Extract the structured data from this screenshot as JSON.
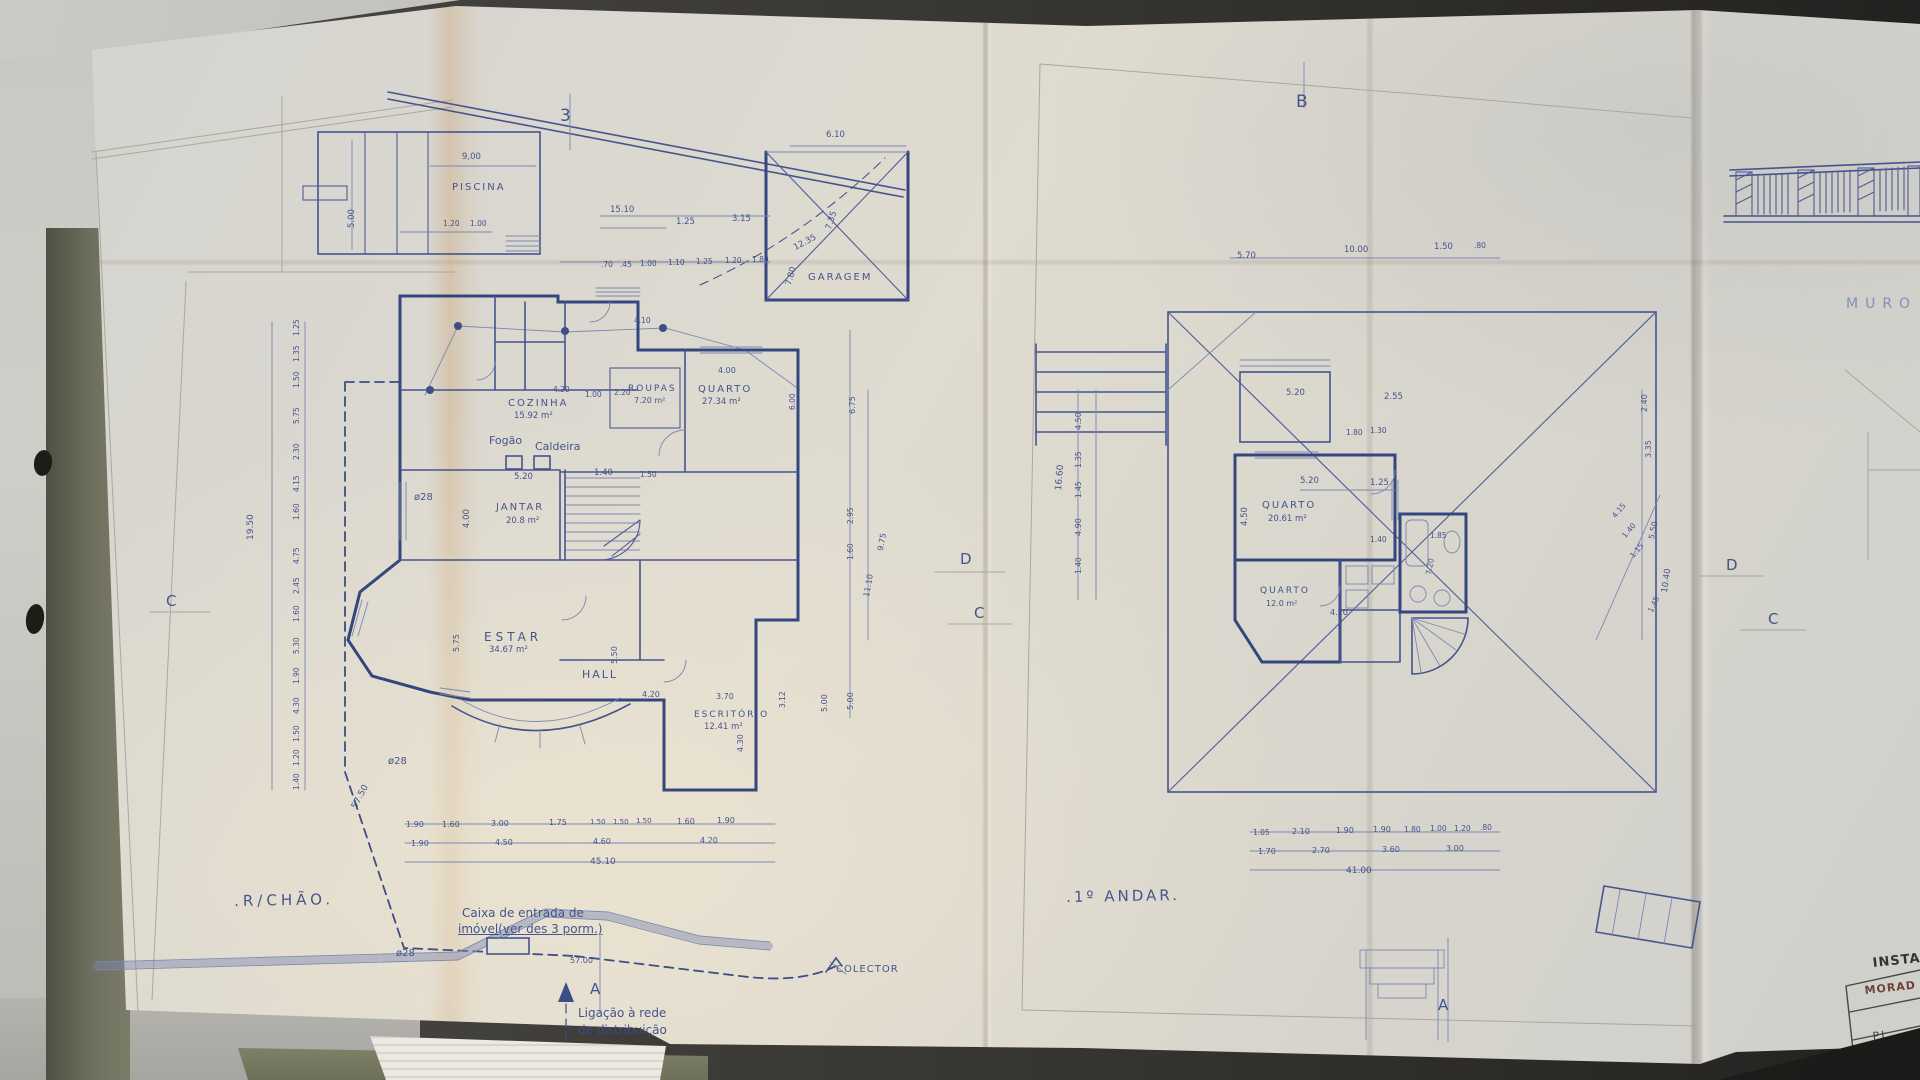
{
  "photo": {
    "paper_color": "#dcd8cd",
    "ink_color": "#44549a",
    "wall_ink_color": "#35467e",
    "pencil_color": "#a9a89e",
    "desk_color": "#c6c5c1",
    "folder_color": "#6e6f5d",
    "stamp_color": "#66392e"
  },
  "left_plan": {
    "title": ".R/CHÃO.",
    "caixa_line1": "Caixa de entrada de",
    "caixa_line2": "imóvel(ver des 3 porm.)",
    "ligacao_line1": "Ligação à rede",
    "ligacao_line2": "de distribuição"
  },
  "right_plan": {
    "title": ".1º ANDAR."
  },
  "right_strip": {
    "muro": "MURO",
    "titleblock_line1": "INSTAL",
    "titleblock_line2": "MORAD",
    "titleblock_line3": "PL"
  },
  "markers": [
    {
      "t": "3",
      "x": 560,
      "y": 106,
      "fs": 17
    },
    {
      "t": "B",
      "x": 1296,
      "y": 92,
      "fs": 17
    },
    {
      "t": "C",
      "x": 166,
      "y": 592
    },
    {
      "t": "D",
      "x": 960,
      "y": 550
    },
    {
      "t": "C",
      "x": 974,
      "y": 604
    },
    {
      "t": "D",
      "x": 1726,
      "y": 556
    },
    {
      "t": "C",
      "x": 1768,
      "y": 610
    },
    {
      "t": "A",
      "x": 590,
      "y": 980
    },
    {
      "t": "A",
      "x": 1438,
      "y": 996
    }
  ],
  "room_labels": [
    {
      "t": "PISCINA",
      "x": 452,
      "y": 182
    },
    {
      "t": "GARAGEM",
      "x": 808,
      "y": 272
    },
    {
      "t": "COZINHA",
      "x": 508,
      "y": 398
    },
    {
      "t": "ROUPAS",
      "x": 628,
      "y": 384,
      "fs": 9
    },
    {
      "t": "QUARTO",
      "x": 698,
      "y": 384
    },
    {
      "t": "JANTAR",
      "x": 496,
      "y": 502
    },
    {
      "t": "ESTAR",
      "x": 484,
      "y": 630,
      "fs": 12,
      "ls": 4
    },
    {
      "t": "HALL",
      "x": 582,
      "y": 668,
      "fs": 11
    },
    {
      "t": "ESCRITÓRIO",
      "x": 694,
      "y": 710,
      "fs": 9
    },
    {
      "t": "QUARTO",
      "x": 1262,
      "y": 500
    },
    {
      "t": "QUARTO",
      "x": 1260,
      "y": 586,
      "fs": 9
    }
  ],
  "area_labels": [
    {
      "t": "15.92 m²",
      "x": 514,
      "y": 411
    },
    {
      "t": "7.20 m²",
      "x": 634,
      "y": 396,
      "fs": 8
    },
    {
      "t": "27.34 m²",
      "x": 702,
      "y": 397
    },
    {
      "t": "20.8 m²",
      "x": 506,
      "y": 516
    },
    {
      "t": "34.67 m²",
      "x": 489,
      "y": 645
    },
    {
      "t": "12.41 m²",
      "x": 704,
      "y": 722
    },
    {
      "t": "20.61 m²",
      "x": 1268,
      "y": 514
    },
    {
      "t": "12.0 m²",
      "x": 1266,
      "y": 599,
      "fs": 8
    }
  ],
  "annotations": [
    {
      "t": "Fogão",
      "x": 489,
      "y": 434,
      "fs": 11
    },
    {
      "t": "Caldeira",
      "x": 535,
      "y": 440,
      "fs": 11
    },
    {
      "t": "COLECTOR",
      "x": 836,
      "y": 964,
      "fs": 10,
      "ls": 1
    },
    {
      "t": "ø28",
      "x": 414,
      "y": 492,
      "fs": 10
    },
    {
      "t": "ø28",
      "x": 388,
      "y": 756,
      "fs": 10
    },
    {
      "t": "ø28",
      "x": 396,
      "y": 948,
      "fs": 10
    }
  ],
  "left_dims": [
    {
      "t": "9,00",
      "x": 462,
      "y": 152
    },
    {
      "t": "5.00",
      "x": 347,
      "y": 228,
      "r": -90
    },
    {
      "t": "1.20",
      "x": 443,
      "y": 219,
      "fs": 7.5
    },
    {
      "t": "1.00",
      "x": 470,
      "y": 219,
      "fs": 7.5
    },
    {
      "t": "15.10",
      "x": 610,
      "y": 205
    },
    {
      "t": "1.25",
      "x": 676,
      "y": 217
    },
    {
      "t": "3.15",
      "x": 732,
      "y": 214
    },
    {
      "t": "6.10",
      "x": 826,
      "y": 130
    },
    {
      "t": "12.35",
      "x": 792,
      "y": 244,
      "r": -28
    },
    {
      "t": "7.35",
      "x": 824,
      "y": 228,
      "r": -72
    },
    {
      "t": "7.80",
      "x": 784,
      "y": 284,
      "r": -75
    },
    {
      "t": ".70",
      "x": 601,
      "y": 260,
      "fs": 7.5
    },
    {
      "t": ".45",
      "x": 620,
      "y": 260,
      "fs": 7.5
    },
    {
      "t": "1.00",
      "x": 640,
      "y": 259,
      "fs": 7.5
    },
    {
      "t": "1.10",
      "x": 668,
      "y": 258,
      "fs": 7.5
    },
    {
      "t": "1.25",
      "x": 696,
      "y": 257,
      "fs": 7.5
    },
    {
      "t": "1.20",
      "x": 725,
      "y": 256,
      "fs": 7.5
    },
    {
      "t": "1.80",
      "x": 752,
      "y": 255,
      "fs": 7.5
    },
    {
      "t": "4.10",
      "x": 634,
      "y": 316,
      "fs": 7.5
    },
    {
      "t": "4.20",
      "x": 553,
      "y": 385,
      "fs": 7.5
    },
    {
      "t": "1.00",
      "x": 585,
      "y": 390,
      "fs": 7.5
    },
    {
      "t": "2.20",
      "x": 614,
      "y": 388,
      "fs": 7.5
    },
    {
      "t": "4.00",
      "x": 718,
      "y": 366,
      "fs": 8
    },
    {
      "t": "6.00",
      "x": 788,
      "y": 410,
      "r": -90,
      "fs": 7.5
    },
    {
      "t": "5.20",
      "x": 514,
      "y": 472
    },
    {
      "t": "1.40",
      "x": 594,
      "y": 468
    },
    {
      "t": "1.50",
      "x": 640,
      "y": 470,
      "fs": 7.5
    },
    {
      "t": "4.00",
      "x": 462,
      "y": 528,
      "r": -90
    },
    {
      "t": "1.25",
      "x": 292,
      "y": 336,
      "r": -90,
      "fs": 7.5
    },
    {
      "t": "1.35",
      "x": 292,
      "y": 362,
      "r": -90,
      "fs": 7.5
    },
    {
      "t": "1.50",
      "x": 292,
      "y": 388,
      "r": -90,
      "fs": 7.5
    },
    {
      "t": "5.75",
      "x": 292,
      "y": 424,
      "r": -90,
      "fs": 7.5
    },
    {
      "t": "2.30",
      "x": 292,
      "y": 460,
      "r": -90,
      "fs": 7.5
    },
    {
      "t": "4.15",
      "x": 292,
      "y": 492,
      "r": -90,
      "fs": 7.5
    },
    {
      "t": "1.60",
      "x": 292,
      "y": 520,
      "r": -90,
      "fs": 7.5
    },
    {
      "t": "4.75",
      "x": 292,
      "y": 564,
      "r": -90,
      "fs": 7.5
    },
    {
      "t": "2.45",
      "x": 292,
      "y": 594,
      "r": -90,
      "fs": 7.5
    },
    {
      "t": "1.60",
      "x": 292,
      "y": 622,
      "r": -90,
      "fs": 7.5
    },
    {
      "t": "5.30",
      "x": 292,
      "y": 654,
      "r": -90,
      "fs": 7.5
    },
    {
      "t": "1.90",
      "x": 292,
      "y": 684,
      "r": -90,
      "fs": 7.5
    },
    {
      "t": "4.30",
      "x": 292,
      "y": 714,
      "r": -90,
      "fs": 7.5
    },
    {
      "t": "1.50",
      "x": 292,
      "y": 742,
      "r": -90,
      "fs": 7.5
    },
    {
      "t": "1.20",
      "x": 292,
      "y": 766,
      "r": -90,
      "fs": 7.5
    },
    {
      "t": "1.40",
      "x": 292,
      "y": 790,
      "r": -90,
      "fs": 7.5
    },
    {
      "t": "19.50",
      "x": 246,
      "y": 540,
      "r": -90,
      "fs": 9
    },
    {
      "t": "57.50",
      "x": 350,
      "y": 806,
      "r": -62,
      "fs": 9
    },
    {
      "t": "6.75",
      "x": 848,
      "y": 414,
      "r": -90,
      "fs": 8
    },
    {
      "t": "9.75",
      "x": 876,
      "y": 550,
      "r": -80,
      "fs": 8
    },
    {
      "t": "2.95",
      "x": 846,
      "y": 524,
      "r": -90,
      "fs": 7.5
    },
    {
      "t": "1.60",
      "x": 846,
      "y": 560,
      "r": -90,
      "fs": 7.5
    },
    {
      "t": "11.10",
      "x": 862,
      "y": 596,
      "r": -80,
      "fs": 8
    },
    {
      "t": "5.00",
      "x": 846,
      "y": 710,
      "r": -90,
      "fs": 8
    },
    {
      "t": "5.75",
      "x": 452,
      "y": 652,
      "r": -90,
      "fs": 8
    },
    {
      "t": "5.50",
      "x": 610,
      "y": 664,
      "r": -90,
      "fs": 8
    },
    {
      "t": "4.20",
      "x": 642,
      "y": 690,
      "fs": 8
    },
    {
      "t": "3.70",
      "x": 716,
      "y": 692,
      "fs": 8
    },
    {
      "t": "4.30",
      "x": 736,
      "y": 752,
      "r": -90,
      "fs": 8
    },
    {
      "t": "3.12",
      "x": 778,
      "y": 708,
      "r": -90,
      "fs": 7.5
    },
    {
      "t": "5.00",
      "x": 820,
      "y": 712,
      "r": -90,
      "fs": 8
    },
    {
      "t": "1.90",
      "x": 406,
      "y": 820,
      "fs": 8
    },
    {
      "t": "1.60",
      "x": 442,
      "y": 820,
      "fs": 8
    },
    {
      "t": "3.00",
      "x": 491,
      "y": 819,
      "fs": 8
    },
    {
      "t": "1.75",
      "x": 549,
      "y": 818,
      "fs": 8
    },
    {
      "t": "1.50",
      "x": 590,
      "y": 818,
      "fs": 7
    },
    {
      "t": "1.50",
      "x": 613,
      "y": 818,
      "fs": 7
    },
    {
      "t": "1.50",
      "x": 636,
      "y": 817,
      "fs": 7
    },
    {
      "t": "1.60",
      "x": 677,
      "y": 817,
      "fs": 8
    },
    {
      "t": "1.90",
      "x": 717,
      "y": 816,
      "fs": 8
    },
    {
      "t": "1.90",
      "x": 411,
      "y": 839,
      "fs": 8
    },
    {
      "t": "4.50",
      "x": 495,
      "y": 838,
      "fs": 8
    },
    {
      "t": "4.60",
      "x": 593,
      "y": 837,
      "fs": 8
    },
    {
      "t": "4.20",
      "x": 700,
      "y": 836,
      "fs": 8
    },
    {
      "t": "45.10",
      "x": 590,
      "y": 857,
      "fs": 9
    },
    {
      "t": "57.00",
      "x": 570,
      "y": 956,
      "fs": 8
    }
  ],
  "right_dims": [
    {
      "t": "5.70",
      "x": 1237,
      "y": 251
    },
    {
      "t": "10.00",
      "x": 1344,
      "y": 245
    },
    {
      "t": "1.50",
      "x": 1434,
      "y": 242
    },
    {
      "t": ".80",
      "x": 1474,
      "y": 241,
      "fs": 7.5
    },
    {
      "t": "5.20",
      "x": 1286,
      "y": 388
    },
    {
      "t": "2.55",
      "x": 1384,
      "y": 392
    },
    {
      "t": "5.20",
      "x": 1300,
      "y": 476
    },
    {
      "t": "1.25",
      "x": 1370,
      "y": 478
    },
    {
      "t": "4.50",
      "x": 1240,
      "y": 526,
      "r": -90
    },
    {
      "t": "1.80",
      "x": 1346,
      "y": 428,
      "fs": 7.5
    },
    {
      "t": "1.30",
      "x": 1370,
      "y": 426,
      "fs": 7.5
    },
    {
      "t": "1.40",
      "x": 1370,
      "y": 535,
      "fs": 7.5
    },
    {
      "t": "1.85",
      "x": 1430,
      "y": 531,
      "fs": 7.5
    },
    {
      "t": "7.20",
      "x": 1424,
      "y": 574,
      "r": -80,
      "fs": 7.5
    },
    {
      "t": "4.20",
      "x": 1330,
      "y": 608,
      "fs": 8
    },
    {
      "t": "4.50",
      "x": 1074,
      "y": 430,
      "r": -90,
      "fs": 8
    },
    {
      "t": "1.35",
      "x": 1074,
      "y": 468,
      "r": -90,
      "fs": 7.5
    },
    {
      "t": "1.45",
      "x": 1074,
      "y": 498,
      "r": -90,
      "fs": 7.5
    },
    {
      "t": "4.90",
      "x": 1074,
      "y": 536,
      "r": -90,
      "fs": 8
    },
    {
      "t": "16.60",
      "x": 1054,
      "y": 490,
      "r": -85,
      "fs": 9
    },
    {
      "t": "1.40",
      "x": 1074,
      "y": 574,
      "r": -90,
      "fs": 7.5
    },
    {
      "t": "2.40",
      "x": 1640,
      "y": 412,
      "r": -90,
      "fs": 8
    },
    {
      "t": "3.35",
      "x": 1644,
      "y": 458,
      "r": -90,
      "fs": 8
    },
    {
      "t": "5.50",
      "x": 1647,
      "y": 538,
      "r": -78,
      "fs": 8
    },
    {
      "t": "10.40",
      "x": 1660,
      "y": 592,
      "r": -82,
      "fs": 8.5
    },
    {
      "t": "4.15",
      "x": 1610,
      "y": 514,
      "r": -50,
      "fs": 7.5
    },
    {
      "t": "1.40",
      "x": 1620,
      "y": 534,
      "r": -50,
      "fs": 7.5
    },
    {
      "t": "1.15",
      "x": 1628,
      "y": 554,
      "r": -50,
      "fs": 7.5
    },
    {
      "t": "1.45",
      "x": 1646,
      "y": 610,
      "r": -65,
      "fs": 7.5
    },
    {
      "t": "1.05",
      "x": 1253,
      "y": 828,
      "fs": 7.5
    },
    {
      "t": "2.10",
      "x": 1292,
      "y": 827,
      "fs": 8
    },
    {
      "t": "1.90",
      "x": 1336,
      "y": 826,
      "fs": 8
    },
    {
      "t": "1.90",
      "x": 1373,
      "y": 825,
      "fs": 8
    },
    {
      "t": "1.80",
      "x": 1404,
      "y": 825,
      "fs": 7.5
    },
    {
      "t": "1.00",
      "x": 1430,
      "y": 824,
      "fs": 7.5
    },
    {
      "t": "1.20",
      "x": 1454,
      "y": 824,
      "fs": 7.5
    },
    {
      "t": ".80",
      "x": 1480,
      "y": 823,
      "fs": 7.5
    },
    {
      "t": "1.70",
      "x": 1258,
      "y": 847,
      "fs": 8
    },
    {
      "t": "2.70",
      "x": 1312,
      "y": 846,
      "fs": 8
    },
    {
      "t": "3.60",
      "x": 1382,
      "y": 845,
      "fs": 8
    },
    {
      "t": "3.00",
      "x": 1446,
      "y": 844,
      "fs": 8
    },
    {
      "t": "41.00",
      "x": 1346,
      "y": 866,
      "fs": 9
    }
  ]
}
